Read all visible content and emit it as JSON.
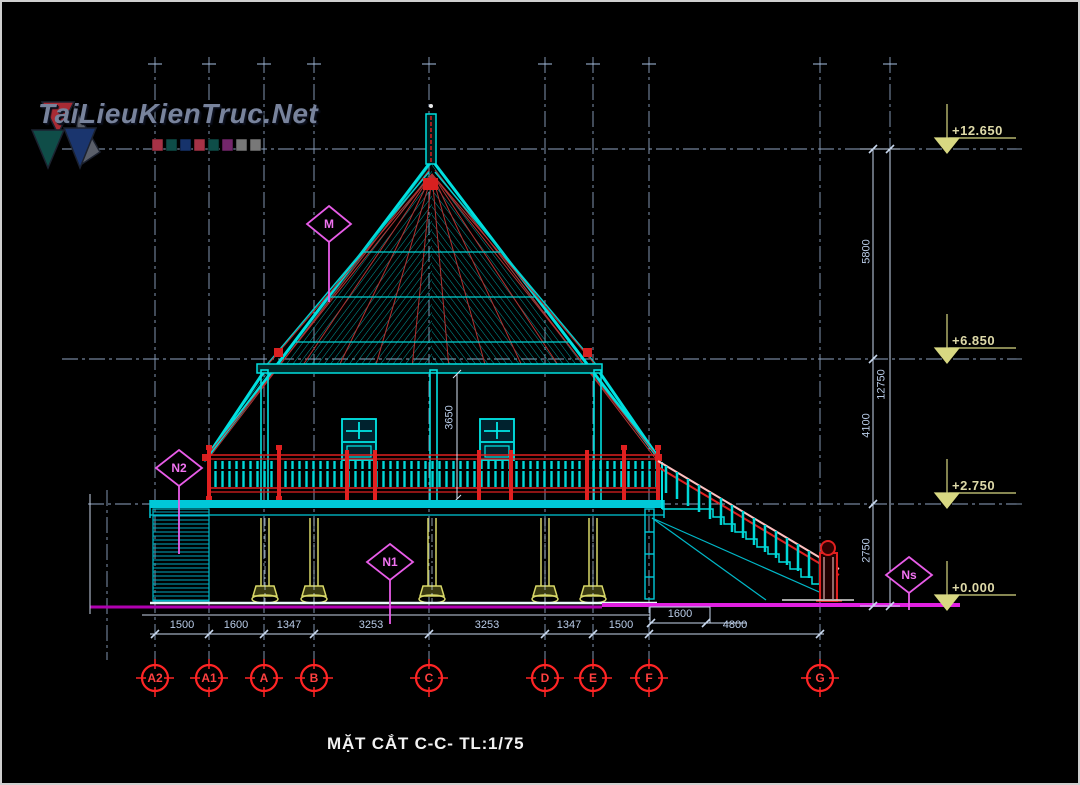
{
  "watermark": {
    "brand": "TaiLieuKienTruc.Net"
  },
  "drawing_title": "MẶT CẮT C-C- TL:1/75",
  "elevation_markers": [
    "+12.650",
    "+6.850",
    "+2.750",
    "+0.000"
  ],
  "vertical_dims": [
    "5800",
    "12750",
    "4100",
    "2750",
    "3650"
  ],
  "horizontal_dims": [
    "1500",
    "1600",
    "1347",
    "3253",
    "3253",
    "1347",
    "1500",
    "4800"
  ],
  "stair_dim": "1600",
  "axis_bubbles": [
    "A2",
    "A1",
    "A",
    "B",
    "C",
    "D",
    "E",
    "F",
    "G"
  ],
  "section_labels": {
    "roof": "M",
    "rail": "N2",
    "floor": "N1",
    "ground": "Ns"
  },
  "colors": {
    "line_cyan": "#00e0e0",
    "line_red": "#ff2222",
    "label_magenta": "#e85ce8",
    "ground_magenta": "#e020e0",
    "dim_blue": "#b9cce8",
    "elevation_yellow": "#ded9a8"
  }
}
